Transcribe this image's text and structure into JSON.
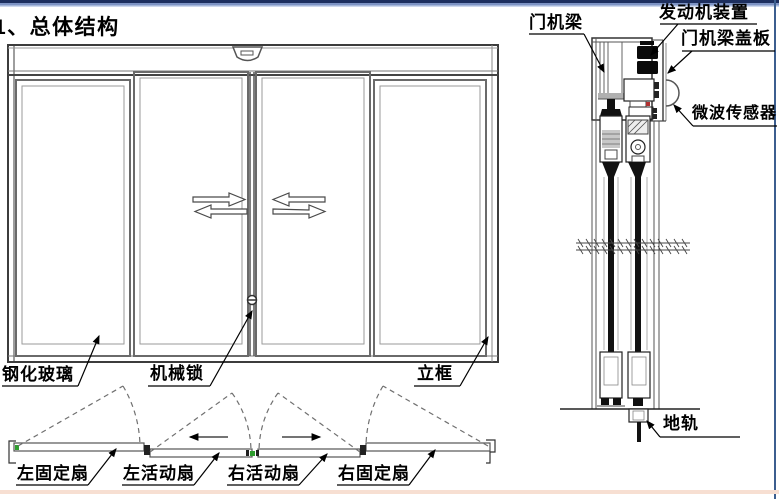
{
  "title": "1、总体结构",
  "elevation": {
    "labels": {
      "glass": "钢化玻璃",
      "lock": "机械锁",
      "frame": "立框"
    }
  },
  "section": {
    "labels": {
      "beam": "门机梁",
      "motor": "发动机装置",
      "cover": "门机梁盖板",
      "sensor": "微波传感器",
      "track": "地轨"
    }
  },
  "plan": {
    "labels": {
      "left_fixed": "左固定扇",
      "left_active": "左活动扇",
      "right_active": "右活动扇",
      "right_fixed": "右固定扇"
    }
  },
  "colors": {
    "accent_navy": "#1d2f5f",
    "border_blue": "#3c5e8f",
    "bottom_peach": "#f7dfd2",
    "line": "#3c3c3c",
    "marker_green": "#2f9e2f",
    "marker_red": "#b03030"
  }
}
